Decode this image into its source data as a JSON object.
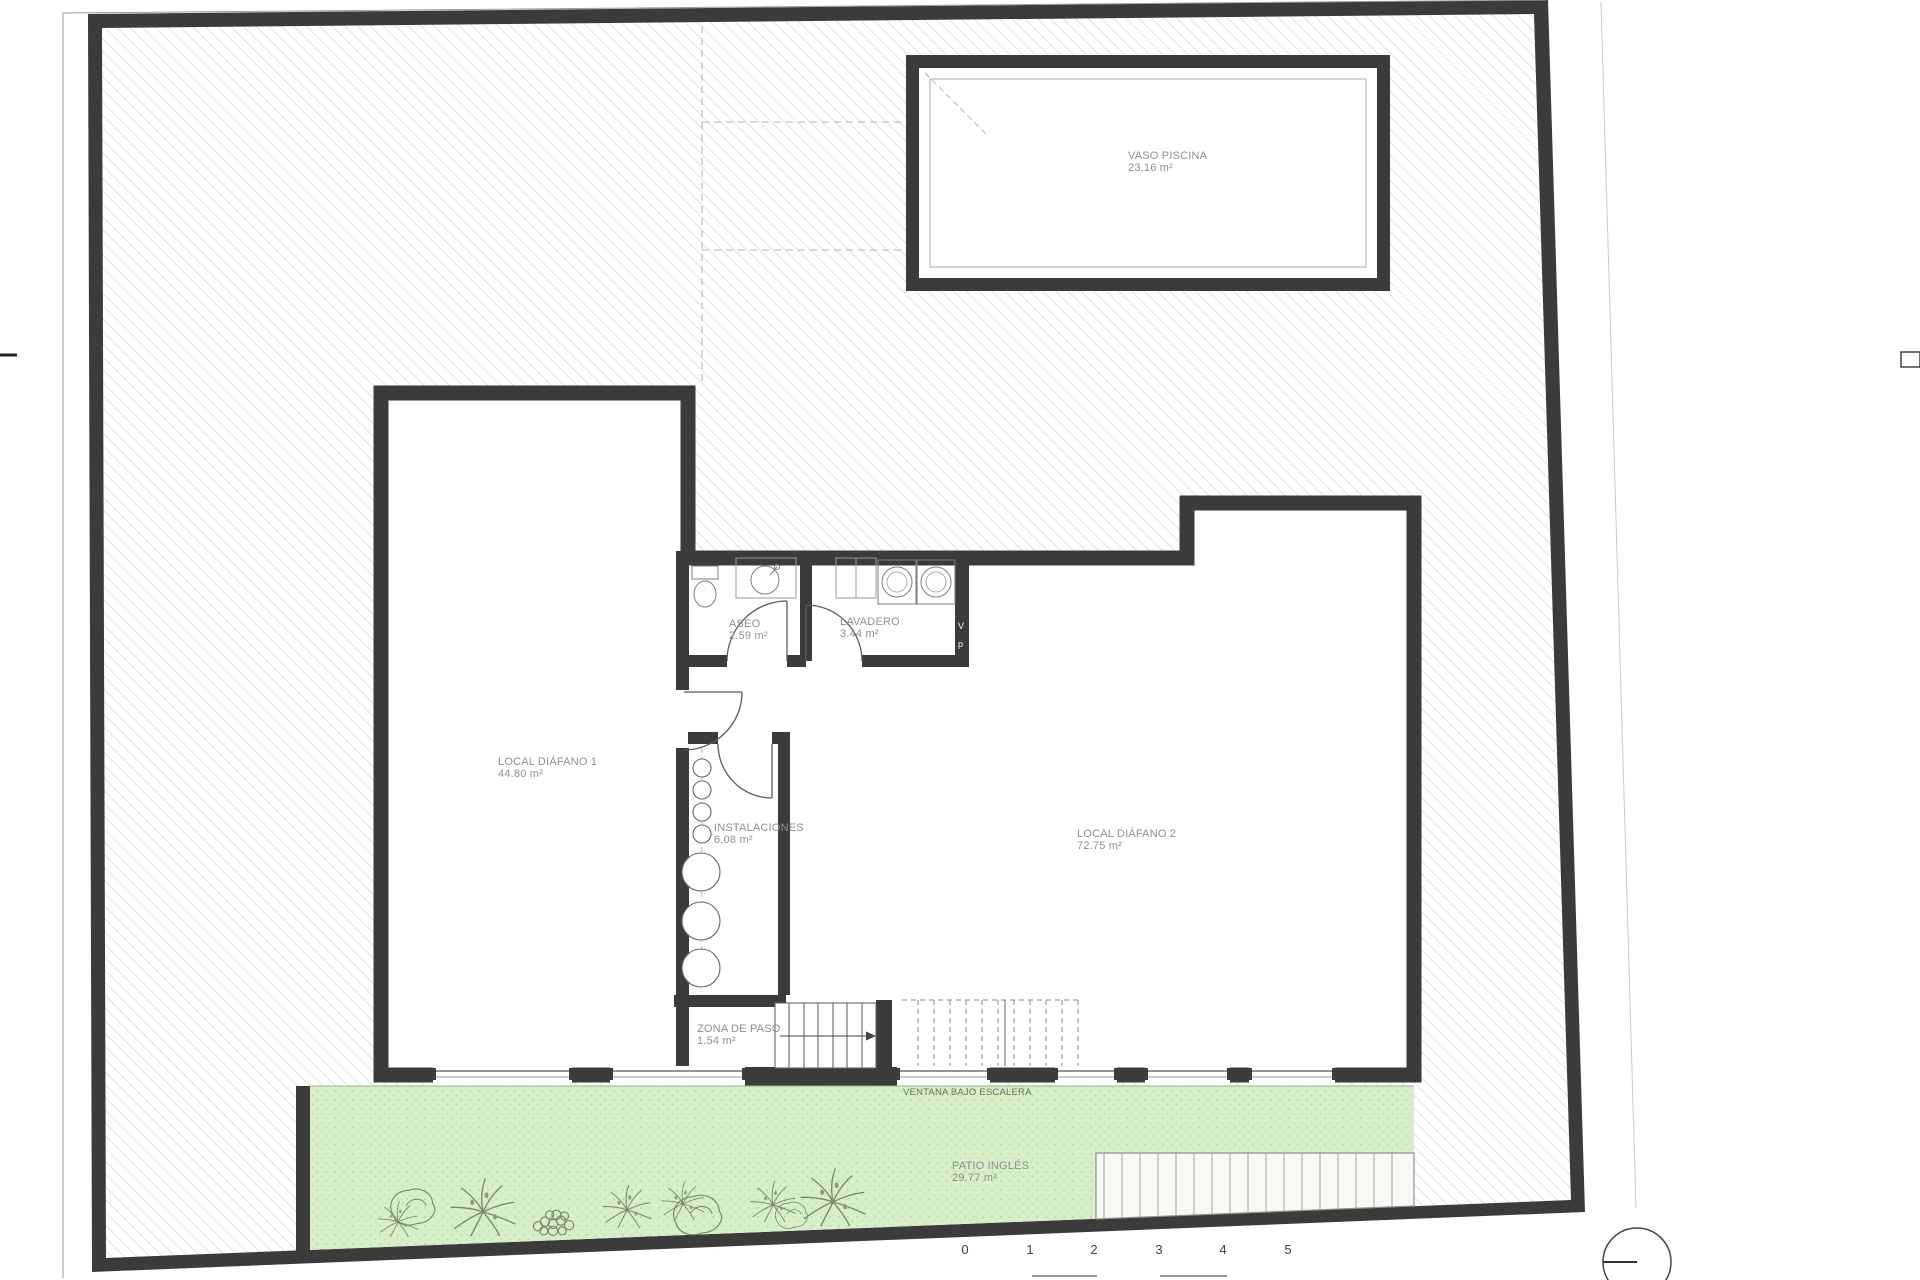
{
  "plan": {
    "rooms": {
      "vaso_piscina": {
        "name": "VASO PISCINA",
        "area": "23.16 m²"
      },
      "local_diafano_1": {
        "name": "LOCAL DIÁFANO 1",
        "area": "44.80 m²"
      },
      "aseo": {
        "name": "ASEO",
        "area": "2.59 m²"
      },
      "lavadero": {
        "name": "LAVADERO",
        "area": "3.44 m²"
      },
      "instalaciones": {
        "name": "INSTALACIONES",
        "area": "6.08 m²"
      },
      "local_diafano_2": {
        "name": "LOCAL DIÁFANO 2",
        "area": "72.75 m²"
      },
      "zona_de_paso": {
        "name": "ZONA DE PASO",
        "area": "1.54 m²"
      },
      "patio_ingles": {
        "name": "PATIO INGLÉS",
        "area": "29.77 m²"
      }
    },
    "annotations": {
      "ventana": "VENTANA BAJO ESCALERA",
      "riser_v": "V",
      "riser_p": "p"
    },
    "scale_bar": {
      "labels": [
        "0",
        "1",
        "2",
        "3",
        "4",
        "5"
      ]
    },
    "colors": {
      "wall": "#3b3b3b",
      "hatch_line": "#dadada",
      "patio_green": "#d6efc8",
      "label_gray": "#8e8e8e"
    }
  }
}
